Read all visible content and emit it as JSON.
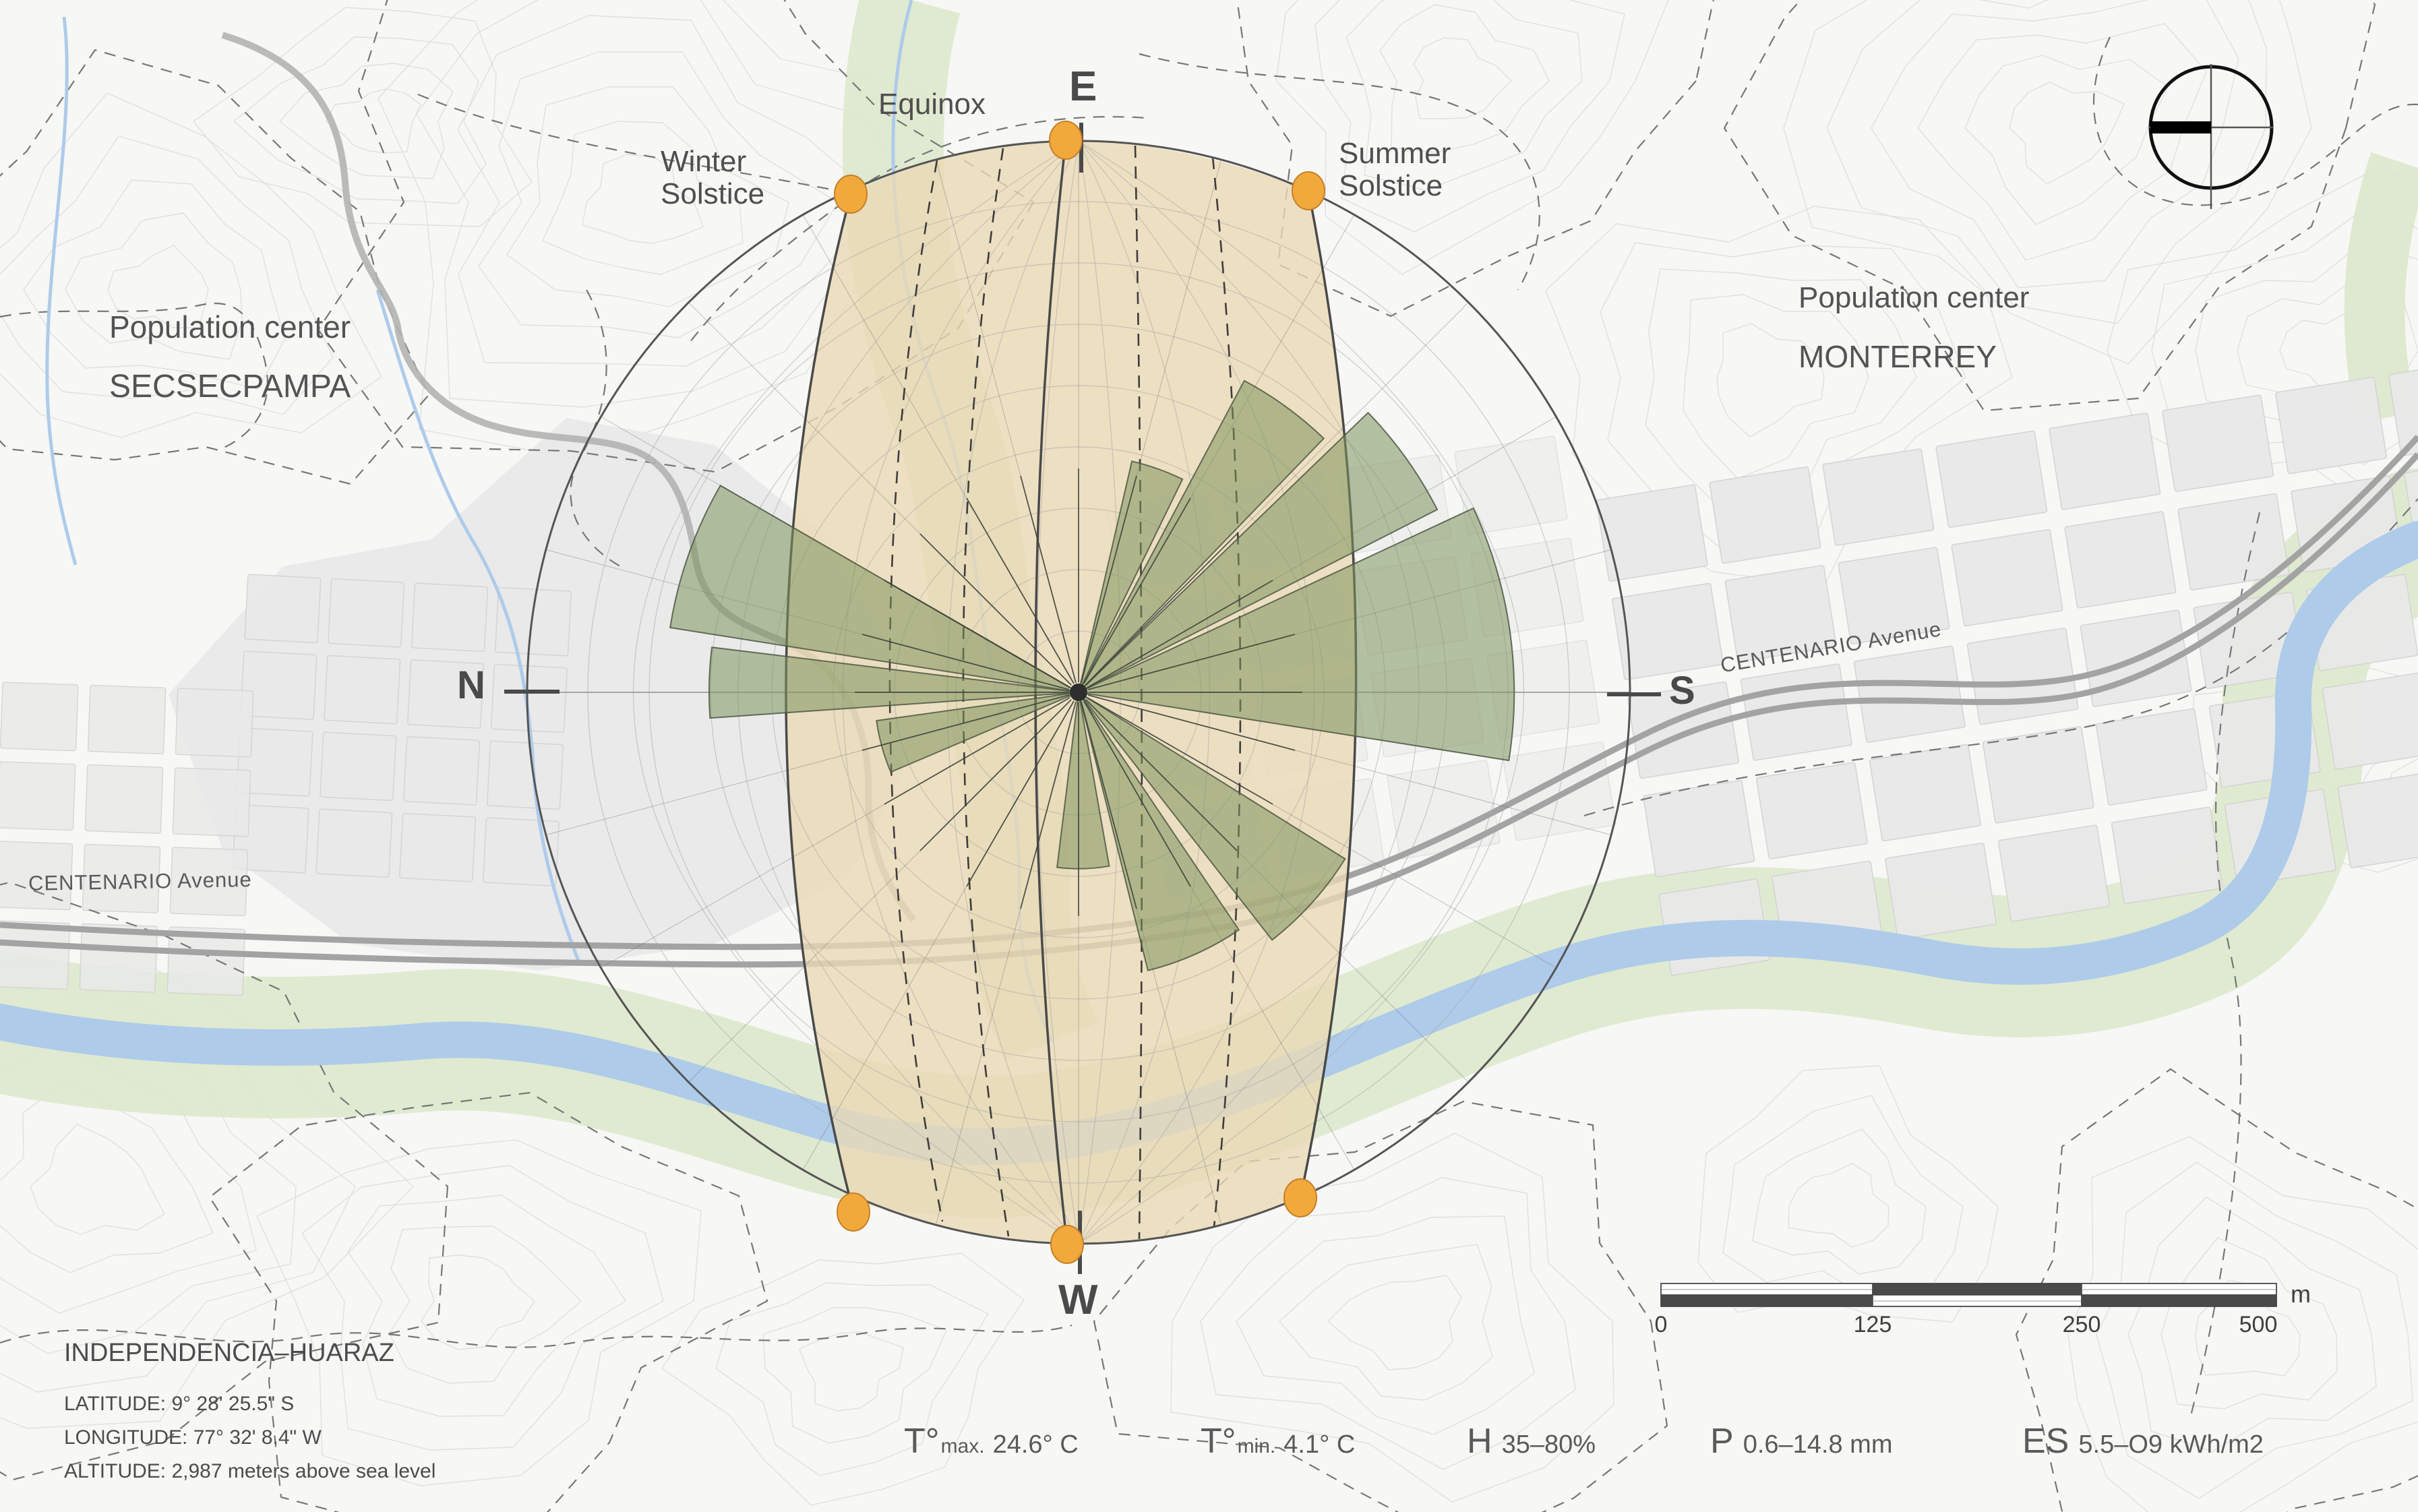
{
  "labels": {
    "equinox": "Equinox",
    "winter": [
      "Winter",
      "Solstice"
    ],
    "summer": [
      "Summer",
      "Solstice"
    ],
    "cardinal": {
      "e": "E",
      "w": "W",
      "n": "N",
      "s": "S"
    },
    "pop1": {
      "line1": "Population center",
      "line2": "SECSECPAMPA"
    },
    "pop2": {
      "line1": "Population center",
      "line2": "MONTERREY"
    },
    "avenue": "CENTENARIO Avenue",
    "location": {
      "title": "INDEPENDENCIA–HUARAZ",
      "latitude": "LATITUDE: 9° 28' 25.5\" S",
      "longitude": "LONGITUDE: 77° 32' 8.4\" W",
      "altitude": "ALTITUDE: 2,987 meters above sea level"
    }
  },
  "climate": [
    {
      "symbol": "T°",
      "sub": "max.",
      "value": "24.6° C"
    },
    {
      "symbol": "T°",
      "sub": "min.",
      "value": "4.1° C"
    },
    {
      "symbol": "H",
      "sub": "",
      "value": "35–80%"
    },
    {
      "symbol": "P",
      "sub": "",
      "value": "0.6–14.8 mm"
    },
    {
      "symbol": "ES",
      "sub": "",
      "value": "5.5–O9 kWh/m2"
    }
  ],
  "scale_bar": {
    "ticks": [
      "0",
      "125",
      "250",
      "500"
    ],
    "unit": "m"
  },
  "sun_path": {
    "season_lines": [
      "Winter Solstice",
      "Equinox",
      "Summer Solstice"
    ],
    "sun_marker_color": "#F2A93C",
    "band_color": "#EBD9B3",
    "markers": 6
  },
  "wind_rose": {
    "note": "petal sectors in compass bearings (map rotated: East at top of image), length normalized to diagram radius",
    "petals": [
      {
        "dir": "S",
        "from": 155,
        "to": 189,
        "len": 0.79
      },
      {
        "dir": "SE",
        "from": 136,
        "to": 153,
        "len": 0.73
      },
      {
        "dir": "SSE",
        "from": 118,
        "to": 134,
        "len": 0.64
      },
      {
        "dir": "ESE",
        "from": 103,
        "to": 116,
        "len": 0.43
      },
      {
        "dir": "NNE",
        "from": 9,
        "to": 30,
        "len": 0.75
      },
      {
        "dir": "N",
        "from": 356,
        "to": 367,
        "len": 0.67
      },
      {
        "dir": "NNW",
        "from": 337,
        "to": 352,
        "len": 0.37
      },
      {
        "dir": "SW",
        "from": 212,
        "to": 232,
        "len": 0.57
      },
      {
        "dir": "WSW",
        "from": 236,
        "to": 256,
        "len": 0.52
      },
      {
        "dir": "W",
        "from": 260,
        "to": 277,
        "len": 0.32
      }
    ],
    "petal_color": "#7E945C"
  },
  "map_features": {
    "river_color": "#AECBEA",
    "vegetation_color": "#DDE8CD",
    "road_color": "#A3A3A3",
    "contour_color": "#E0E0E0",
    "urban_color": "#E9E9E9"
  }
}
